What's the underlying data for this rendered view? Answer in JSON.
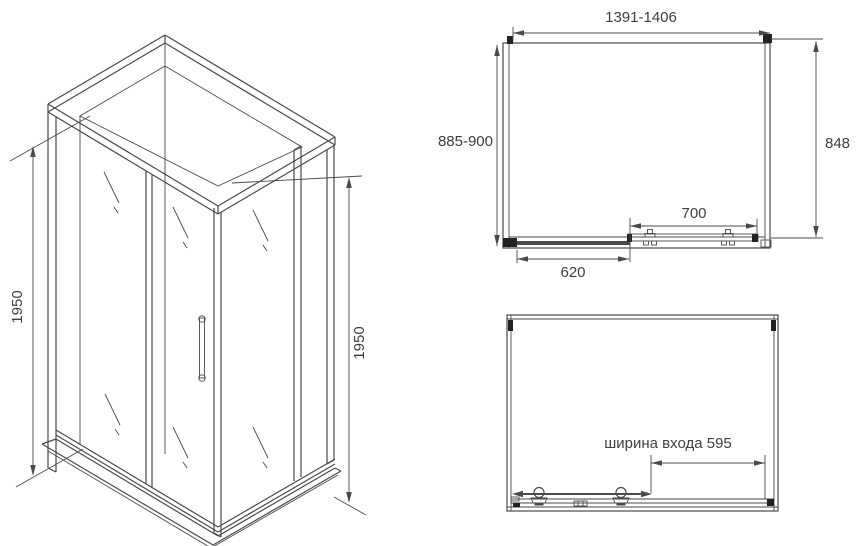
{
  "colors": {
    "line": "#4a4a4a",
    "text": "#3f3f3f",
    "bracket": "#222222",
    "background": "#ffffff"
  },
  "iso_view": {
    "height_left": "1950",
    "height_right": "1950"
  },
  "plan_view": {
    "width_range": "1391-1406",
    "depth_range": "885-900",
    "side_depth": "848",
    "door_width": "700",
    "fixed_panel_width": "620"
  },
  "elevation_view": {
    "entrance_width_label": "ширина входа 595"
  }
}
